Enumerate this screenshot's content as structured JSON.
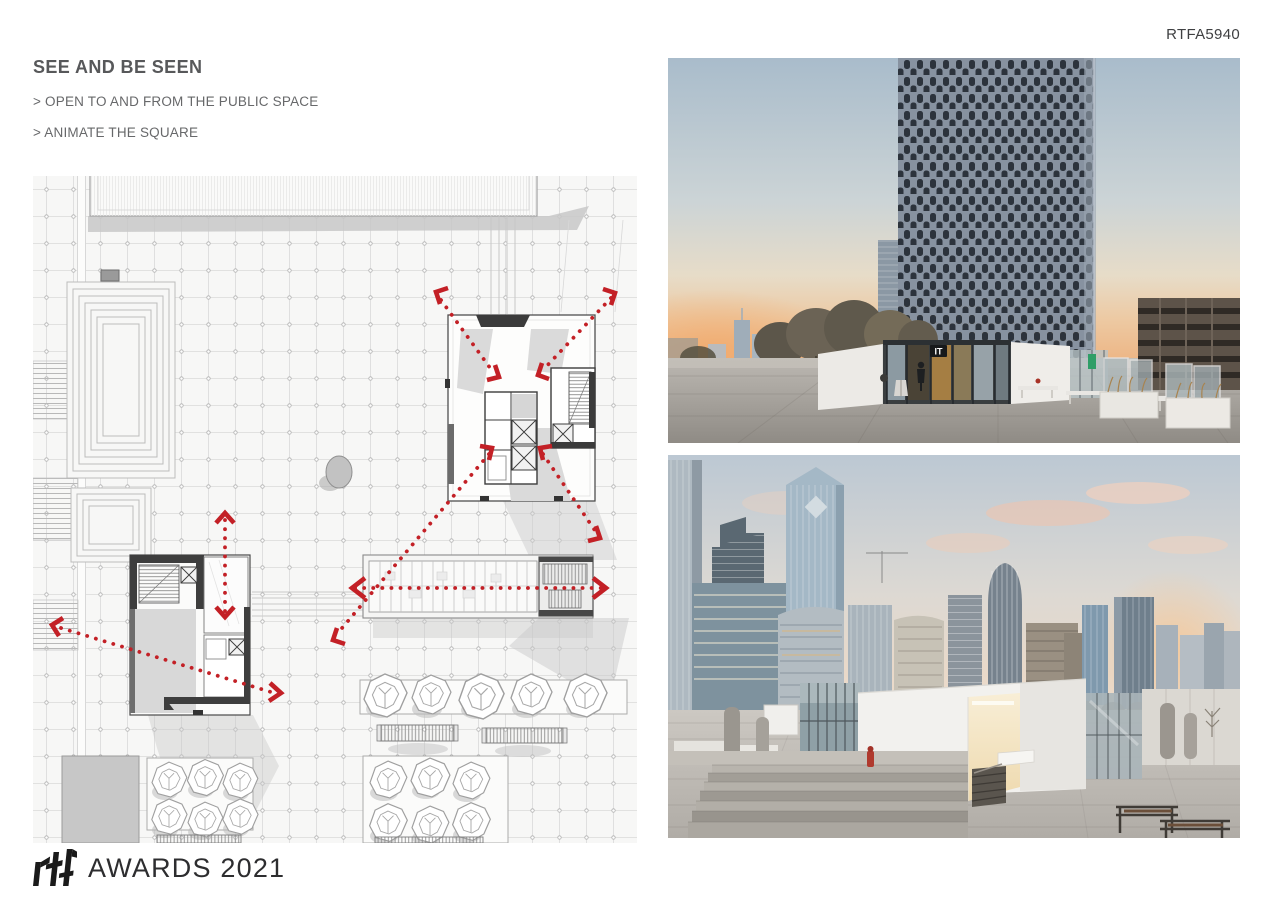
{
  "page": {
    "code": "RTFA5940"
  },
  "header": {
    "title": "SEE AND BE SEEN",
    "bullets": [
      "> OPEN TO AND FROM THE PUBLIC SPACE",
      "> ANIMATE THE SQUARE"
    ]
  },
  "photos": {
    "top": {
      "sign": "IT"
    }
  },
  "footer": {
    "brand": "rtf",
    "label": "AWARDS 2021"
  },
  "colors": {
    "accent_red": "#c32026",
    "heading_gray": "#57585a",
    "body_gray": "#67686a",
    "plan_line": "#d6d6d6"
  }
}
